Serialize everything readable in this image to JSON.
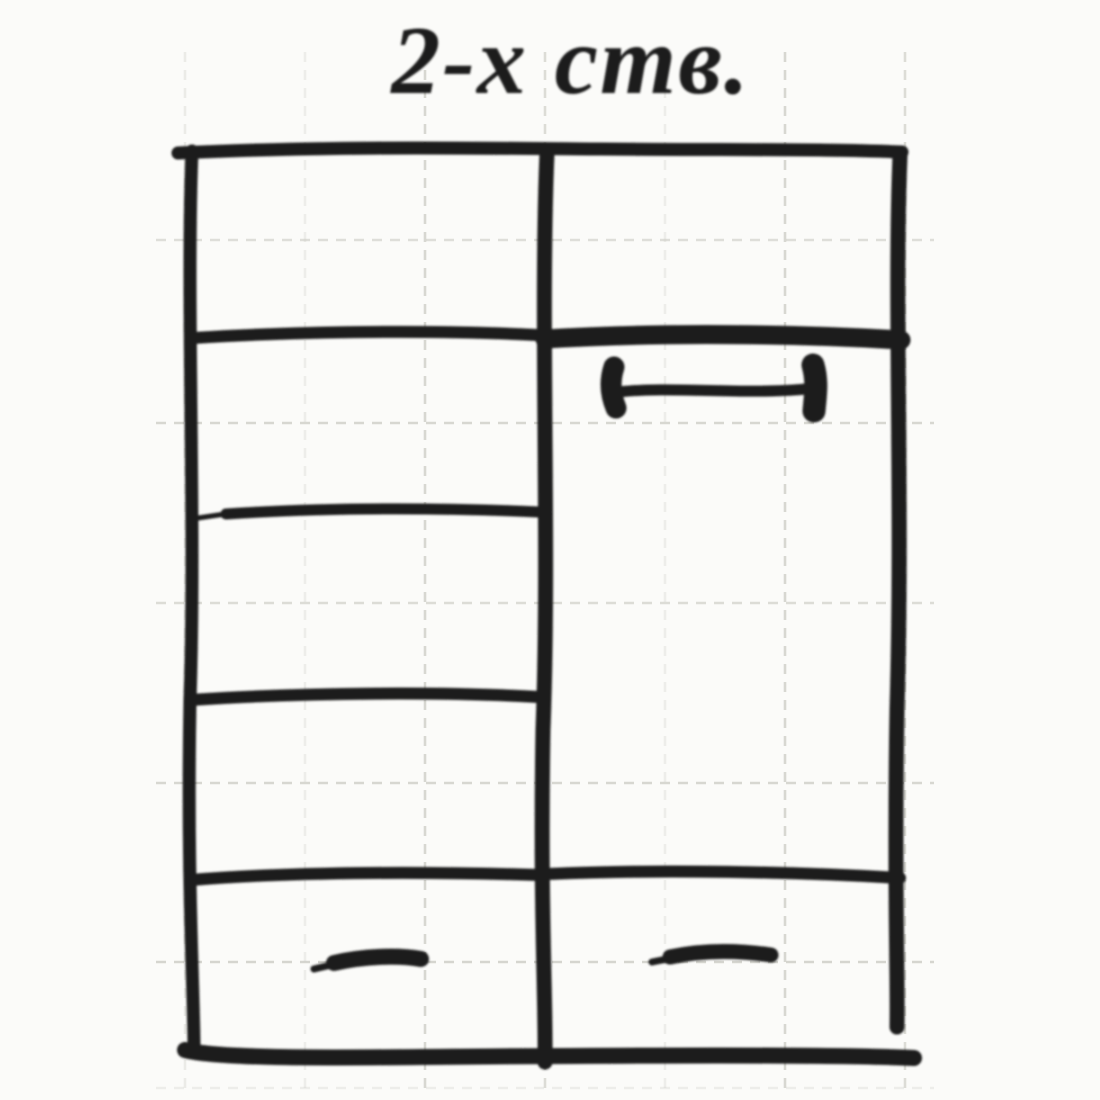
{
  "title": {
    "text": "2-х ств."
  },
  "colors": {
    "ink": "#1a1a1a",
    "paper": "#fbfbf9",
    "grid": "#cfcfc8"
  }
}
